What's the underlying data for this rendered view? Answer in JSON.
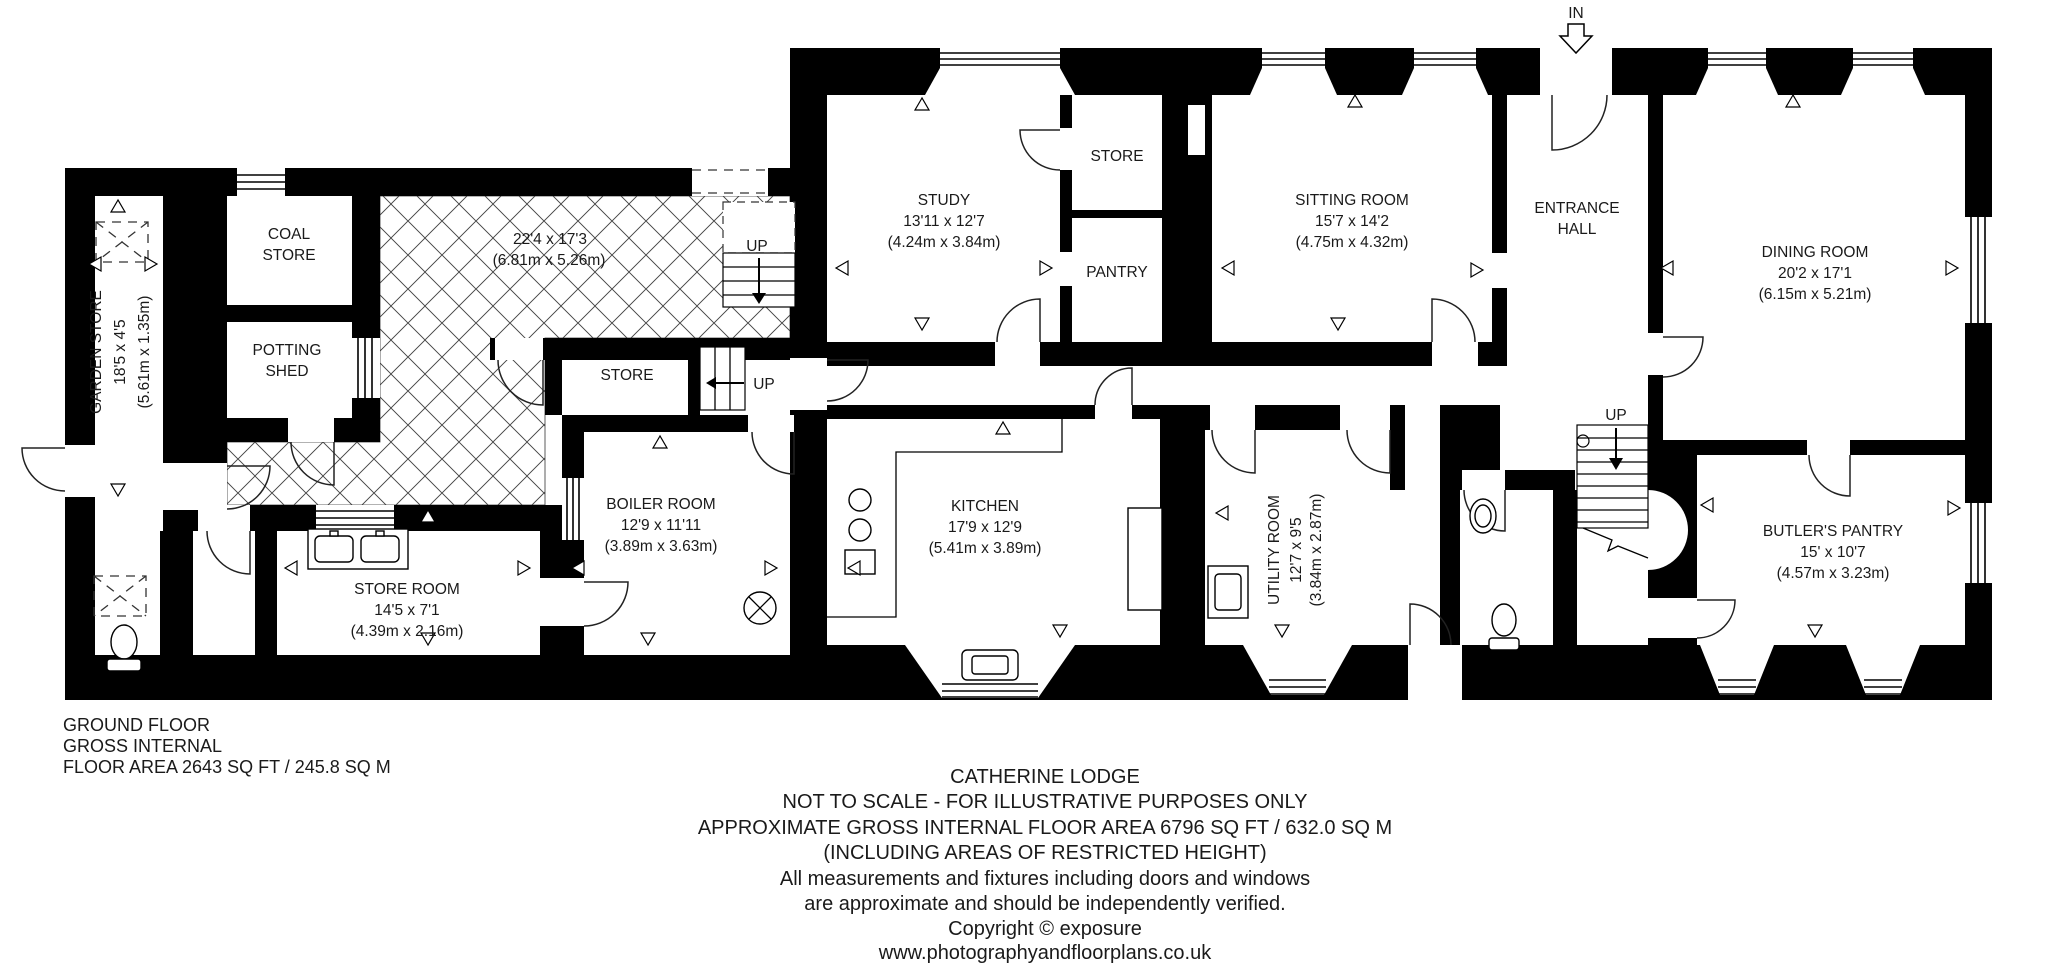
{
  "plan_title": "Catherine Lodge Ground Floor Plan",
  "rooms": {
    "garden_store": {
      "name": "GARDEN STORE",
      "dims": "18'5 x 4'5",
      "metric": "(5.61m x 1.35m)"
    },
    "coal_store": {
      "line1": "COAL",
      "line2": "STORE"
    },
    "potting_shed": {
      "line1": "POTTING",
      "line2": "SHED"
    },
    "courtyard": {
      "dims": "22'4 x 17'3",
      "metric": "(6.81m x 5.26m)"
    },
    "store_outbuilding": {
      "name": "STORE"
    },
    "store_room": {
      "name": "STORE ROOM",
      "dims": "14'5 x 7'1",
      "metric": "(4.39m x 2.16m)"
    },
    "boiler_room": {
      "name": "BOILER ROOM",
      "dims": "12'9 x 11'11",
      "metric": "(3.89m x 3.63m)"
    },
    "kitchen": {
      "name": "KITCHEN",
      "dims": "17'9 x 12'9",
      "metric": "(5.41m x 3.89m)"
    },
    "study": {
      "name": "STUDY",
      "dims": "13'11 x 12'7",
      "metric": "(4.24m x 3.84m)"
    },
    "store_hall": {
      "name": "STORE"
    },
    "pantry": {
      "name": "PANTRY"
    },
    "sitting_room": {
      "name": "SITTING ROOM",
      "dims": "15'7 x 14'2",
      "metric": "(4.75m x 4.32m)"
    },
    "entrance_hall": {
      "line1": "ENTRANCE",
      "line2": "HALL"
    },
    "dining_room": {
      "name": "DINING ROOM",
      "dims": "20'2 x 17'1",
      "metric": "(6.15m x 5.21m)"
    },
    "utility_room": {
      "name": "UTILITY ROOM",
      "dims": "12'7 x 9'5",
      "metric": "(3.84m x 2.87m)"
    },
    "butlers_pantry": {
      "name": "BUTLER'S PANTRY",
      "dims": "15' x 10'7",
      "metric": "(4.57m x 3.23m)"
    }
  },
  "annotations": {
    "in_label": "IN",
    "up_label": "UP"
  },
  "title_block": {
    "line1": "GROUND FLOOR",
    "line2": "GROSS INTERNAL",
    "line3": "FLOOR AREA 2643 SQ FT / 245.8 SQ M"
  },
  "footer": {
    "line1": "CATHERINE LODGE",
    "line2": "NOT TO SCALE - FOR ILLUSTRATIVE PURPOSES ONLY",
    "line3": "APPROXIMATE GROSS INTERNAL FLOOR AREA 6796 SQ FT / 632.0 SQ M",
    "line4": "(INCLUDING AREAS OF RESTRICTED HEIGHT)",
    "line5": "All measurements and fixtures including doors and windows",
    "line6": "are approximate and should be independently verified.",
    "line7": "Copyright © exposure",
    "line8": "www.photographyandfloorplans.co.uk"
  }
}
